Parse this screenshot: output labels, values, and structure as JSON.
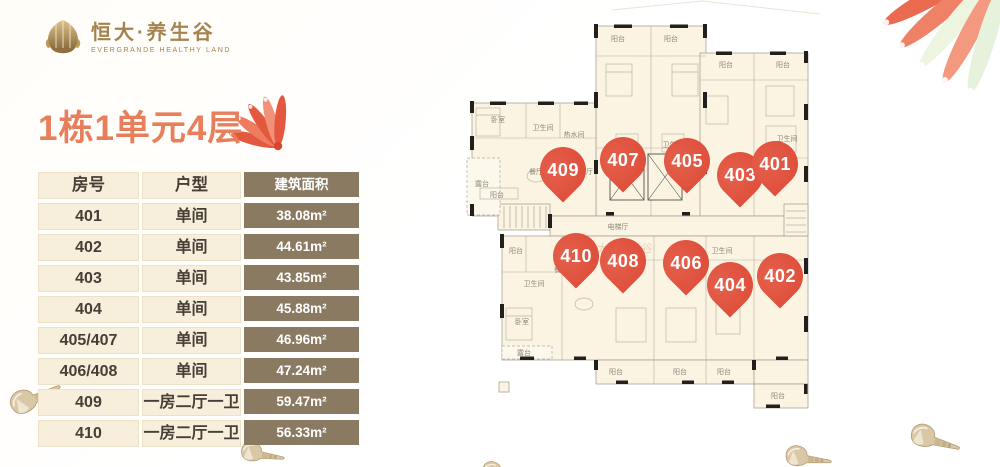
{
  "logo": {
    "brand": "恒大·养生谷",
    "subtitle": "EVERGRANDE HEALTHY LAND"
  },
  "title": "1栋1单元4层",
  "table": {
    "headers": [
      "房号",
      "户型",
      "建筑面积"
    ],
    "rows": [
      {
        "room": "401",
        "type": "单间",
        "area": "38.08m²"
      },
      {
        "room": "402",
        "type": "单间",
        "area": "44.61m²"
      },
      {
        "room": "403",
        "type": "单间",
        "area": "43.85m²"
      },
      {
        "room": "404",
        "type": "单间",
        "area": "45.88m²"
      },
      {
        "room": "405/407",
        "type": "单间",
        "area": "46.96m²"
      },
      {
        "room": "406/408",
        "type": "单间",
        "area": "47.24m²"
      },
      {
        "room": "409",
        "type": "一房二厅一卫",
        "area": "59.47m²"
      },
      {
        "room": "410",
        "type": "一房二厅一卫",
        "area": "56.33m²"
      }
    ]
  },
  "floor_plan": {
    "watermark": "恒大·养生谷",
    "pin_color": "#E0523E",
    "units": [
      {
        "number": "409",
        "x": 97,
        "y": 162
      },
      {
        "number": "407",
        "x": 157,
        "y": 152
      },
      {
        "number": "405",
        "x": 221,
        "y": 153
      },
      {
        "number": "403",
        "x": 274,
        "y": 167
      },
      {
        "number": "401",
        "x": 309,
        "y": 156
      },
      {
        "number": "410",
        "x": 110,
        "y": 248
      },
      {
        "number": "408",
        "x": 157,
        "y": 253
      },
      {
        "number": "406",
        "x": 220,
        "y": 255
      },
      {
        "number": "404",
        "x": 264,
        "y": 277
      },
      {
        "number": "402",
        "x": 314,
        "y": 268
      }
    ],
    "room_labels": [
      {
        "text": "阳台",
        "x": 152,
        "y": 31
      },
      {
        "text": "阳台",
        "x": 205,
        "y": 31
      },
      {
        "text": "阳台",
        "x": 260,
        "y": 57
      },
      {
        "text": "阳台",
        "x": 317,
        "y": 57
      },
      {
        "text": "卧室",
        "x": 32,
        "y": 112
      },
      {
        "text": "卫生间",
        "x": 77,
        "y": 120
      },
      {
        "text": "热水间",
        "x": 108,
        "y": 127
      },
      {
        "text": "餐厅",
        "x": 70,
        "y": 164
      },
      {
        "text": "餐厅",
        "x": 120,
        "y": 164
      },
      {
        "text": "露台",
        "x": 16,
        "y": 176
      },
      {
        "text": "阳台",
        "x": 31,
        "y": 187
      },
      {
        "text": "卫生间",
        "x": 161,
        "y": 137
      },
      {
        "text": "卫生间",
        "x": 207,
        "y": 137
      },
      {
        "text": "卫生间",
        "x": 321,
        "y": 131
      },
      {
        "text": "电梯厅",
        "x": 152,
        "y": 219
      },
      {
        "text": "阳台",
        "x": 50,
        "y": 243
      },
      {
        "text": "卫生间",
        "x": 68,
        "y": 276
      },
      {
        "text": "卧室",
        "x": 56,
        "y": 314
      },
      {
        "text": "餐厅",
        "x": 95,
        "y": 262
      },
      {
        "text": "卫生间",
        "x": 256,
        "y": 243
      },
      {
        "text": "阳台",
        "x": 150,
        "y": 364
      },
      {
        "text": "阳台",
        "x": 214,
        "y": 364
      },
      {
        "text": "阳台",
        "x": 258,
        "y": 364
      },
      {
        "text": "阳台",
        "x": 312,
        "y": 388
      },
      {
        "text": "露台",
        "x": 58,
        "y": 345
      }
    ]
  },
  "colors": {
    "accent_coral": "#E87E5B",
    "pin_red": "#E0523E",
    "table_brown": "#8A7A62",
    "table_cream": "#F7EFDC",
    "logo_gold": "#A6834E"
  }
}
